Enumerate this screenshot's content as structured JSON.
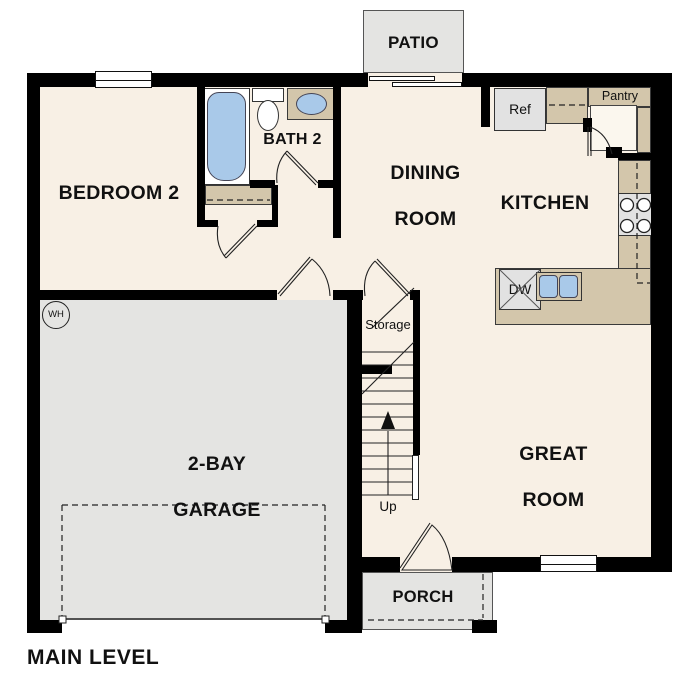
{
  "plan": {
    "floor_label": "MAIN LEVEL",
    "rooms": {
      "patio": {
        "label": "PATIO"
      },
      "bedroom2": {
        "label": "BEDROOM 2"
      },
      "bath2": {
        "label": "BATH 2"
      },
      "dining": {
        "line1": "DINING",
        "line2": "ROOM"
      },
      "kitchen": {
        "label": "KITCHEN"
      },
      "great_room": {
        "line1": "GREAT",
        "line2": "ROOM"
      },
      "garage": {
        "line1": "2-BAY",
        "line2": "GARAGE"
      },
      "storage": {
        "label": "Storage"
      },
      "porch": {
        "label": "PORCH"
      }
    },
    "annotations": {
      "ref": "Ref",
      "pantry": "Pantry",
      "dw": "DW",
      "wh": "WH",
      "up": "Up"
    },
    "colors": {
      "wall": "#000000",
      "floor": "#f8f0e5",
      "concrete": "#e4e4e2",
      "counter": "#d3c6ab",
      "fixture_blue": "#a9c9e9"
    }
  }
}
